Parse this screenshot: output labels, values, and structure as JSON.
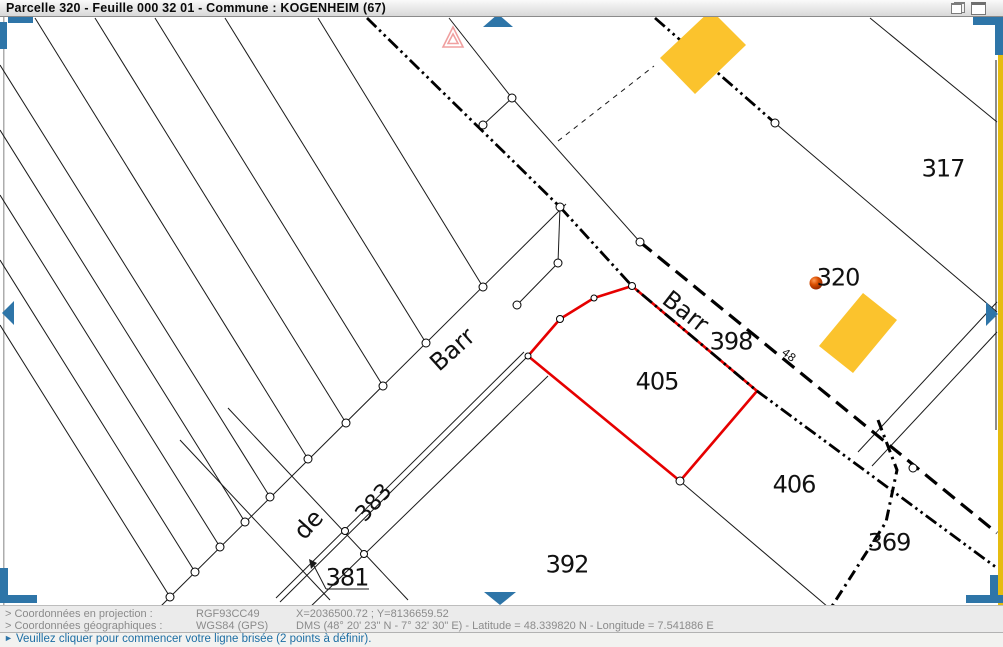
{
  "title_bar": {
    "title": "Parcelle 320 - Feuille 000 32 01 - Commune : KOGENHEIM (67)"
  },
  "map": {
    "parcel_labels": [
      {
        "label": "317",
        "x": 943,
        "y": 168
      },
      {
        "label": "320",
        "x": 838,
        "y": 277
      },
      {
        "label": "398",
        "x": 731,
        "y": 341
      },
      {
        "label": "405",
        "x": 657,
        "y": 381
      },
      {
        "label": "406",
        "x": 794,
        "y": 484
      },
      {
        "label": "369",
        "x": 889,
        "y": 542
      },
      {
        "label": "392",
        "x": 567,
        "y": 564
      },
      {
        "label": "381",
        "x": 347,
        "y": 577
      }
    ],
    "street_labels": [
      {
        "label": "Barr",
        "x": 452,
        "y": 349,
        "rotate": -42,
        "size": 24
      },
      {
        "label": "de",
        "x": 308,
        "y": 524,
        "rotate": -48,
        "size": 24
      },
      {
        "label": "383",
        "x": 373,
        "y": 502,
        "rotate": -48,
        "size": 22
      },
      {
        "label": "Barr",
        "x": 686,
        "y": 311,
        "rotate": 38,
        "size": 24
      },
      {
        "label": "48",
        "x": 789,
        "y": 355,
        "rotate": 38,
        "size": 11
      }
    ],
    "colors": {
      "selected_parcel_outline": "#e60000",
      "building_fill": "#fbc32d",
      "nav_arrow": "#2e75a8",
      "parcel_point_marker": "#cc3a00",
      "warning_triangle": "#f0a0a0",
      "right_edge_strip": "#e6bc10"
    }
  },
  "status_bar": {
    "rows": [
      {
        "label": "> Coordonnées en projection :",
        "system": "RGF93CC49",
        "values": "X=2036500.72 ; Y=8136659.52"
      },
      {
        "label": "> Coordonnées géographiques :",
        "system": "WGS84 (GPS)",
        "values": "DMS (48° 20' 23\" N - 7° 32' 30\" E) - Latitude = 48.339820 N - Longitude = 7.541886 E"
      }
    ]
  },
  "message_bar": {
    "icon": "►",
    "text": "Veuillez cliquer pour commencer votre ligne brisée (2 points à définir)."
  }
}
